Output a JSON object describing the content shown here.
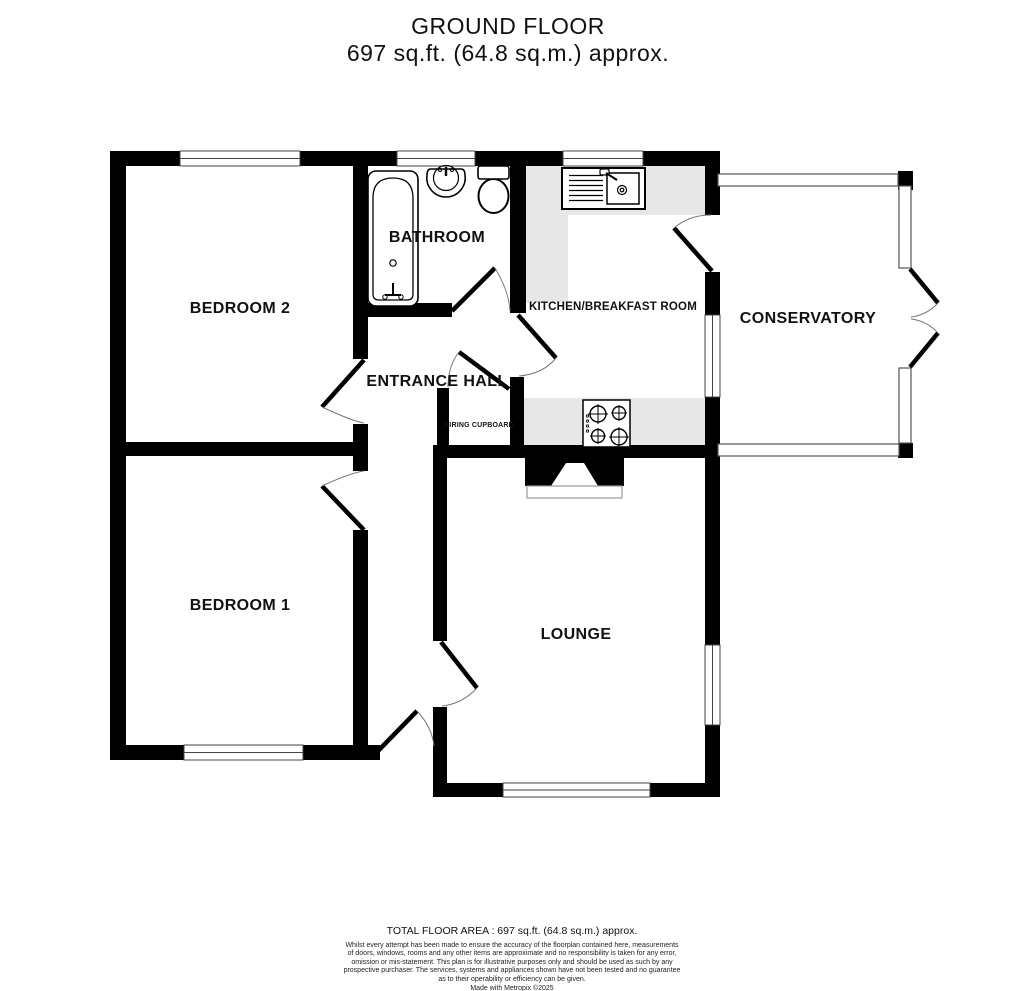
{
  "title": {
    "line1": "GROUND FLOOR",
    "line2": "697 sq.ft. (64.8 sq.m.) approx."
  },
  "rooms": {
    "bedroom2": {
      "label": "BEDROOM 2"
    },
    "bathroom": {
      "label": "BATHROOM"
    },
    "kitchen": {
      "label": "KITCHEN/BREAKFAST ROOM"
    },
    "conservatory": {
      "label": "CONSERVATORY"
    },
    "entrance_hall": {
      "label": "ENTRANCE HALL"
    },
    "airing_cupboard": {
      "label": "AIRING CUPBOARD"
    },
    "bedroom1": {
      "label": "BEDROOM 1"
    },
    "lounge": {
      "label": "LOUNGE"
    }
  },
  "fixtures": {
    "bathtub": "bathtub with taps",
    "basin": "wash basin",
    "toilet": "toilet with cistern",
    "kitchen_sink": "sink and drainer unit",
    "hob": "four ring hob",
    "fireplace": "chimney breast with hearth"
  },
  "footer": {
    "total_area": "TOTAL FLOOR AREA : 697 sq.ft. (64.8 sq.m.) approx.",
    "disclaimer_lines": [
      "Whilst every attempt has been made to ensure the accuracy of the floorplan contained here, measurements",
      "of doors, windows, rooms and any other items are approximate and no responsibility is taken for any error,",
      "omission or mis-statement. This plan is for illustrative purposes only and should be used as such by any",
      "prospective purchaser. The services, systems and appliances shown have not been tested and no guarantee",
      "as to their operability or efficiency can be given."
    ],
    "credit": "Made with Metropix ©2025"
  },
  "colors": {
    "wall": "#000000",
    "counter": "#e7e7e7",
    "window_line": "#555555",
    "label": "#111111"
  }
}
